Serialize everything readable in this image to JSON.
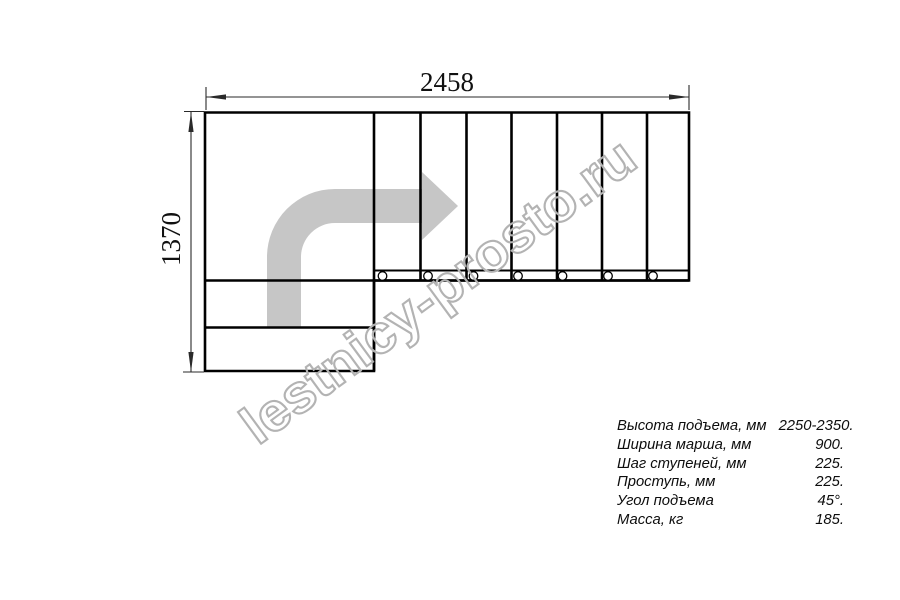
{
  "drawing": {
    "title": "staircase-plan-top-view",
    "dimensions": {
      "width_label": "2458",
      "height_label": "1370"
    },
    "watermark": "lestnicy-prosto.ru",
    "steps_count": 7,
    "baluster_count": 7,
    "colors": {
      "line": "#000000",
      "dimension": "#2a2a2a",
      "direction_arrow": "#c6c6c6",
      "watermark": "#b3b3b3"
    }
  },
  "specs": {
    "rows": [
      {
        "label": "Высота подъема, мм",
        "value": "2250-2350."
      },
      {
        "label": "Ширина марша, мм",
        "value": "900."
      },
      {
        "label": "Шаг ступеней, мм",
        "value": "225."
      },
      {
        "label": "Проступь, мм",
        "value": "225."
      },
      {
        "label": "Угол подъема",
        "value": "45°."
      },
      {
        "label": "Масса, кг",
        "value": "185."
      }
    ]
  }
}
